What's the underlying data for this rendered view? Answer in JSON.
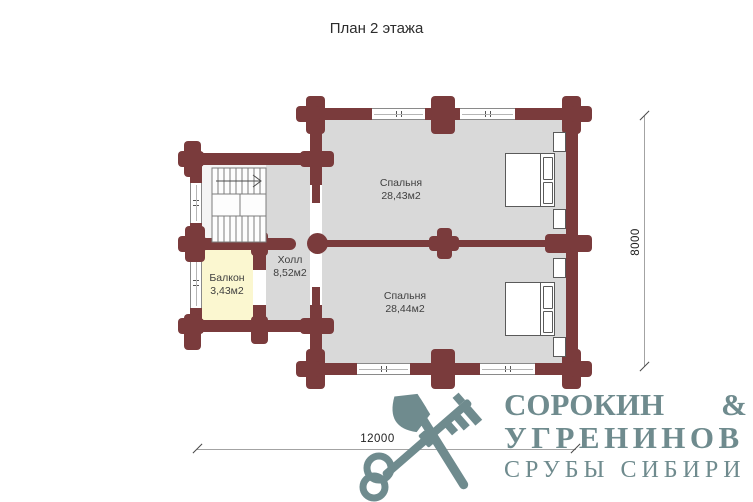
{
  "title": "План 2 этажа",
  "rooms": {
    "bedroom1": {
      "name": "Спальня",
      "area": "28,43м2"
    },
    "bedroom2": {
      "name": "Спальня",
      "area": "28,44м2"
    },
    "hall": {
      "name": "Холл",
      "area": "8,52м2"
    },
    "balcony": {
      "name": "Балкон",
      "area": "3,43м2"
    }
  },
  "dimensions": {
    "width_mm": "12000",
    "height_mm": "8000"
  },
  "logo": {
    "word1": "СОРОКИН",
    "amp": "&",
    "word2": "УГРЕНИНОВ",
    "tagline": "СРУБЫ СИБИРИ"
  },
  "colors": {
    "wall": "#7a3b3c",
    "floor": "#d9d9d9",
    "balcony_floor": "#fbf7d0",
    "logo": "#6f8b8e"
  }
}
